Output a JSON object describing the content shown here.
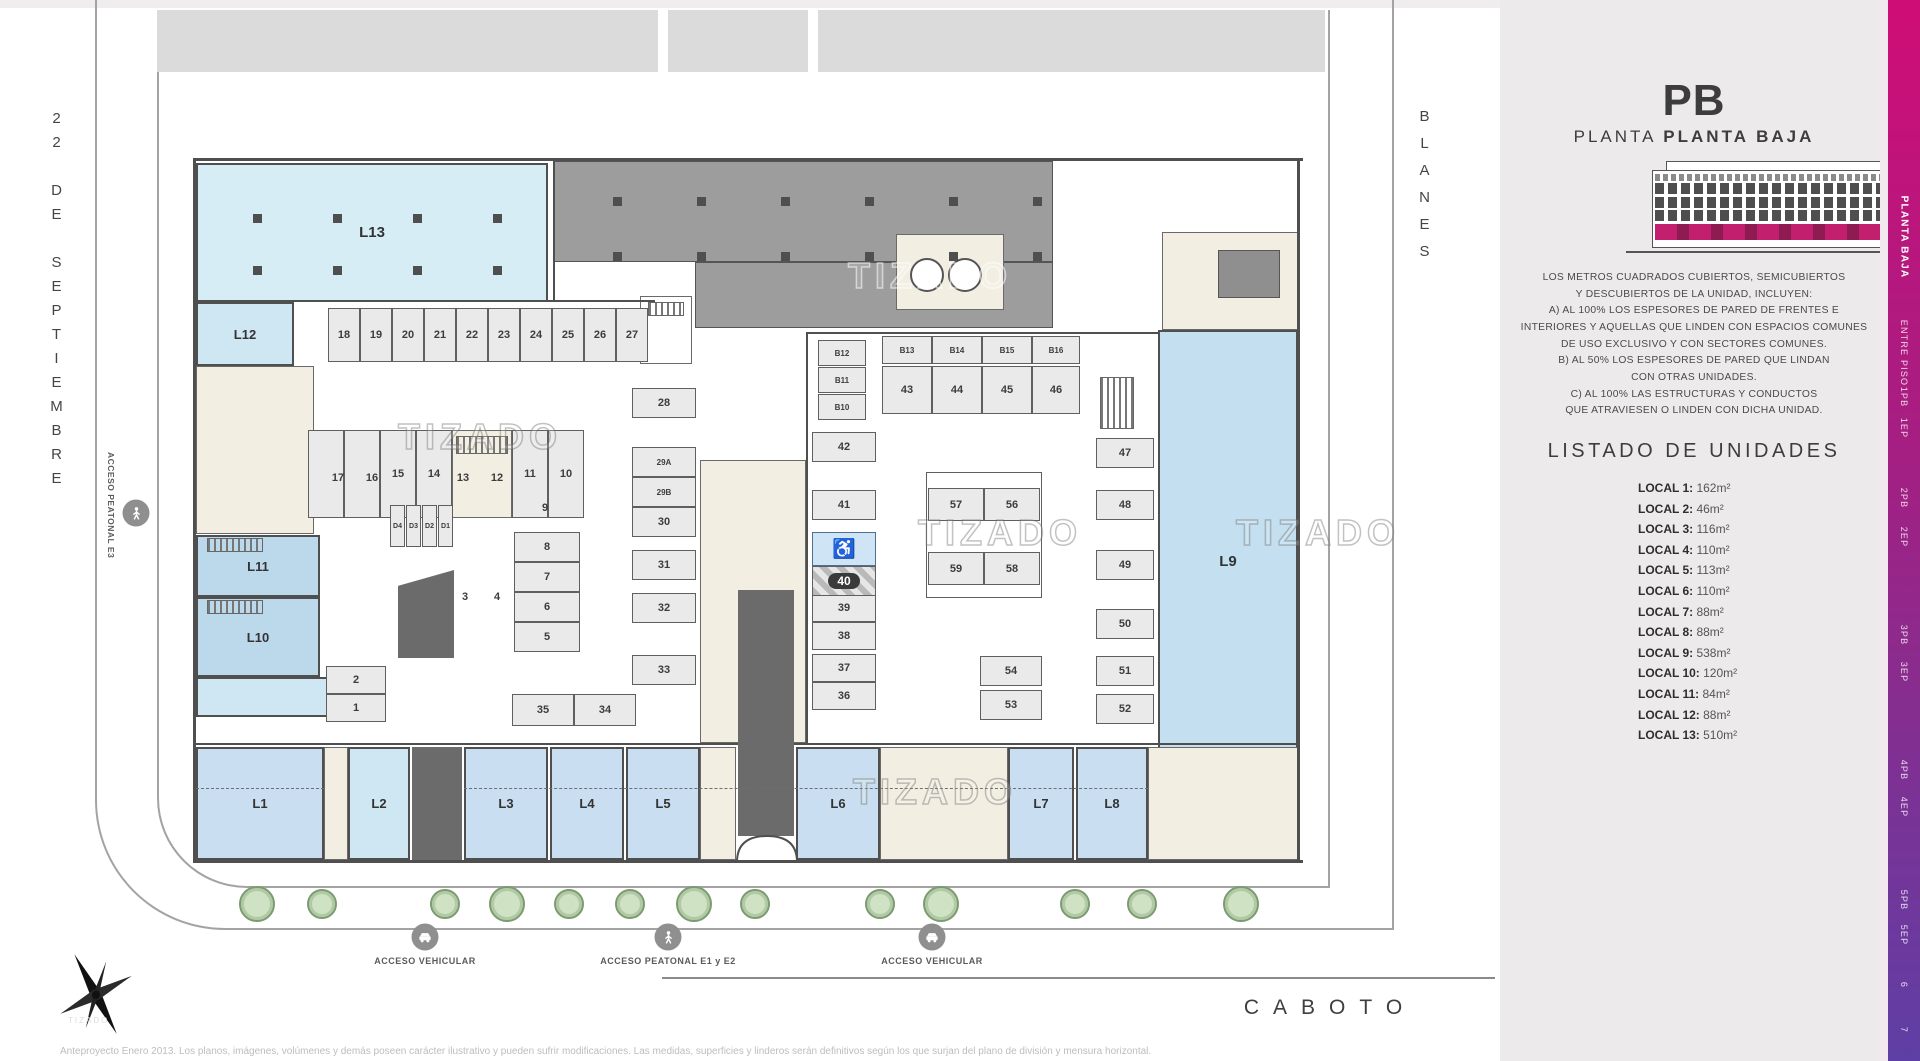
{
  "header": {
    "floor_code": "PB",
    "plan_word": "PLANTA",
    "floor_name": "PLANTA BAJA"
  },
  "streets": {
    "left": "22 DE SEPTIEMBRE",
    "right": "BLANES",
    "bottom": "CABOTO"
  },
  "watermark": "TIZADO",
  "notes": "LOS METROS CUADRADOS CUBIERTOS, SEMICUBIERTOS\nY DESCUBIERTOS DE LA UNIDAD, INCLUYEN:\nA) AL 100% LOS ESPESORES DE PARED DE FRENTES E\nINTERIORES Y AQUELLAS QUE LINDEN CON ESPACIOS COMUNES\nDE USO EXCLUSIVO Y CON SECTORES COMUNES.\nB) AL 50% LOS ESPESORES DE PARED QUE LINDAN\nCON OTRAS UNIDADES.\nC) AL 100% LAS ESTRUCTURAS Y CONDUCTOS\nQUE ATRAVIESEN O LINDEN CON DICHA UNIDAD.",
  "units_heading": "LISTADO DE UNIDADES",
  "units": [
    {
      "name": "LOCAL 1",
      "area": "162m²"
    },
    {
      "name": "LOCAL 2",
      "area": "46m²"
    },
    {
      "name": "LOCAL 3",
      "area": "116m²"
    },
    {
      "name": "LOCAL 4",
      "area": "110m²"
    },
    {
      "name": "LOCAL 5",
      "area": "113m²"
    },
    {
      "name": "LOCAL 6",
      "area": "110m²"
    },
    {
      "name": "LOCAL 7",
      "area": "88m²"
    },
    {
      "name": "LOCAL 8",
      "area": "88m²"
    },
    {
      "name": "LOCAL 9",
      "area": "538m²"
    },
    {
      "name": "LOCAL 10",
      "area": "120m²"
    },
    {
      "name": "LOCAL 11",
      "area": "84m²"
    },
    {
      "name": "LOCAL 12",
      "area": "88m²"
    },
    {
      "name": "LOCAL 13",
      "area": "510m²"
    }
  ],
  "floors": {
    "active": "PLANTA BAJA",
    "tabs": [
      "PLANTA BAJA",
      "ENTRE PISO",
      "1PB",
      "1EP",
      "2PB",
      "2EP",
      "3PB",
      "3EP",
      "4PB",
      "4EP",
      "5PB",
      "5EP",
      "6",
      "7"
    ]
  },
  "accesses": {
    "side": {
      "label": "ACCESO PEATONAL E3",
      "icon": "person-icon"
    },
    "bottom": [
      {
        "label": "ACCESO VEHICULAR",
        "icon": "car"
      },
      {
        "label": "ACCESO PEATONAL E1 y E2",
        "icon": "person"
      },
      {
        "label": "ACCESO VEHICULAR",
        "icon": "car"
      }
    ]
  },
  "plan": {
    "locals": [
      "L13",
      "L12",
      "L11",
      "L10",
      "L9",
      "L1",
      "L2",
      "L3",
      "L4",
      "L5",
      "L6",
      "L7",
      "L8"
    ],
    "stalls": [
      "18",
      "19",
      "20",
      "21",
      "22",
      "23",
      "24",
      "25",
      "26",
      "27",
      "15",
      "14",
      "11",
      "10",
      "8",
      "7",
      "6",
      "5",
      "2",
      "1",
      "28",
      "29A",
      "29B",
      "30",
      "31",
      "32",
      "33",
      "35",
      "34",
      "B12",
      "B11",
      "B10",
      "42",
      "41",
      "39",
      "38",
      "37",
      "36",
      "B13",
      "B14",
      "B15",
      "B16",
      "43",
      "44",
      "45",
      "46",
      "57",
      "56",
      "59",
      "58",
      "54",
      "53",
      "47",
      "48",
      "49",
      "50",
      "51",
      "52",
      "D4",
      "D3",
      "D2",
      "D1"
    ],
    "float_labels": [
      "17",
      "16",
      "13",
      "12",
      "9",
      "3",
      "4"
    ],
    "highlighted_stall": "40",
    "accessible_icon": "♿"
  },
  "disclaimer": "Anteproyecto Enero 2013. Los planos, imágenes, volúmenes y demás poseen carácter ilustrativo y pueden sufrir modificaciones. Las medidas, superficies y linderos serán definitivos según los que surjan del plano de división y mensura horizontal."
}
